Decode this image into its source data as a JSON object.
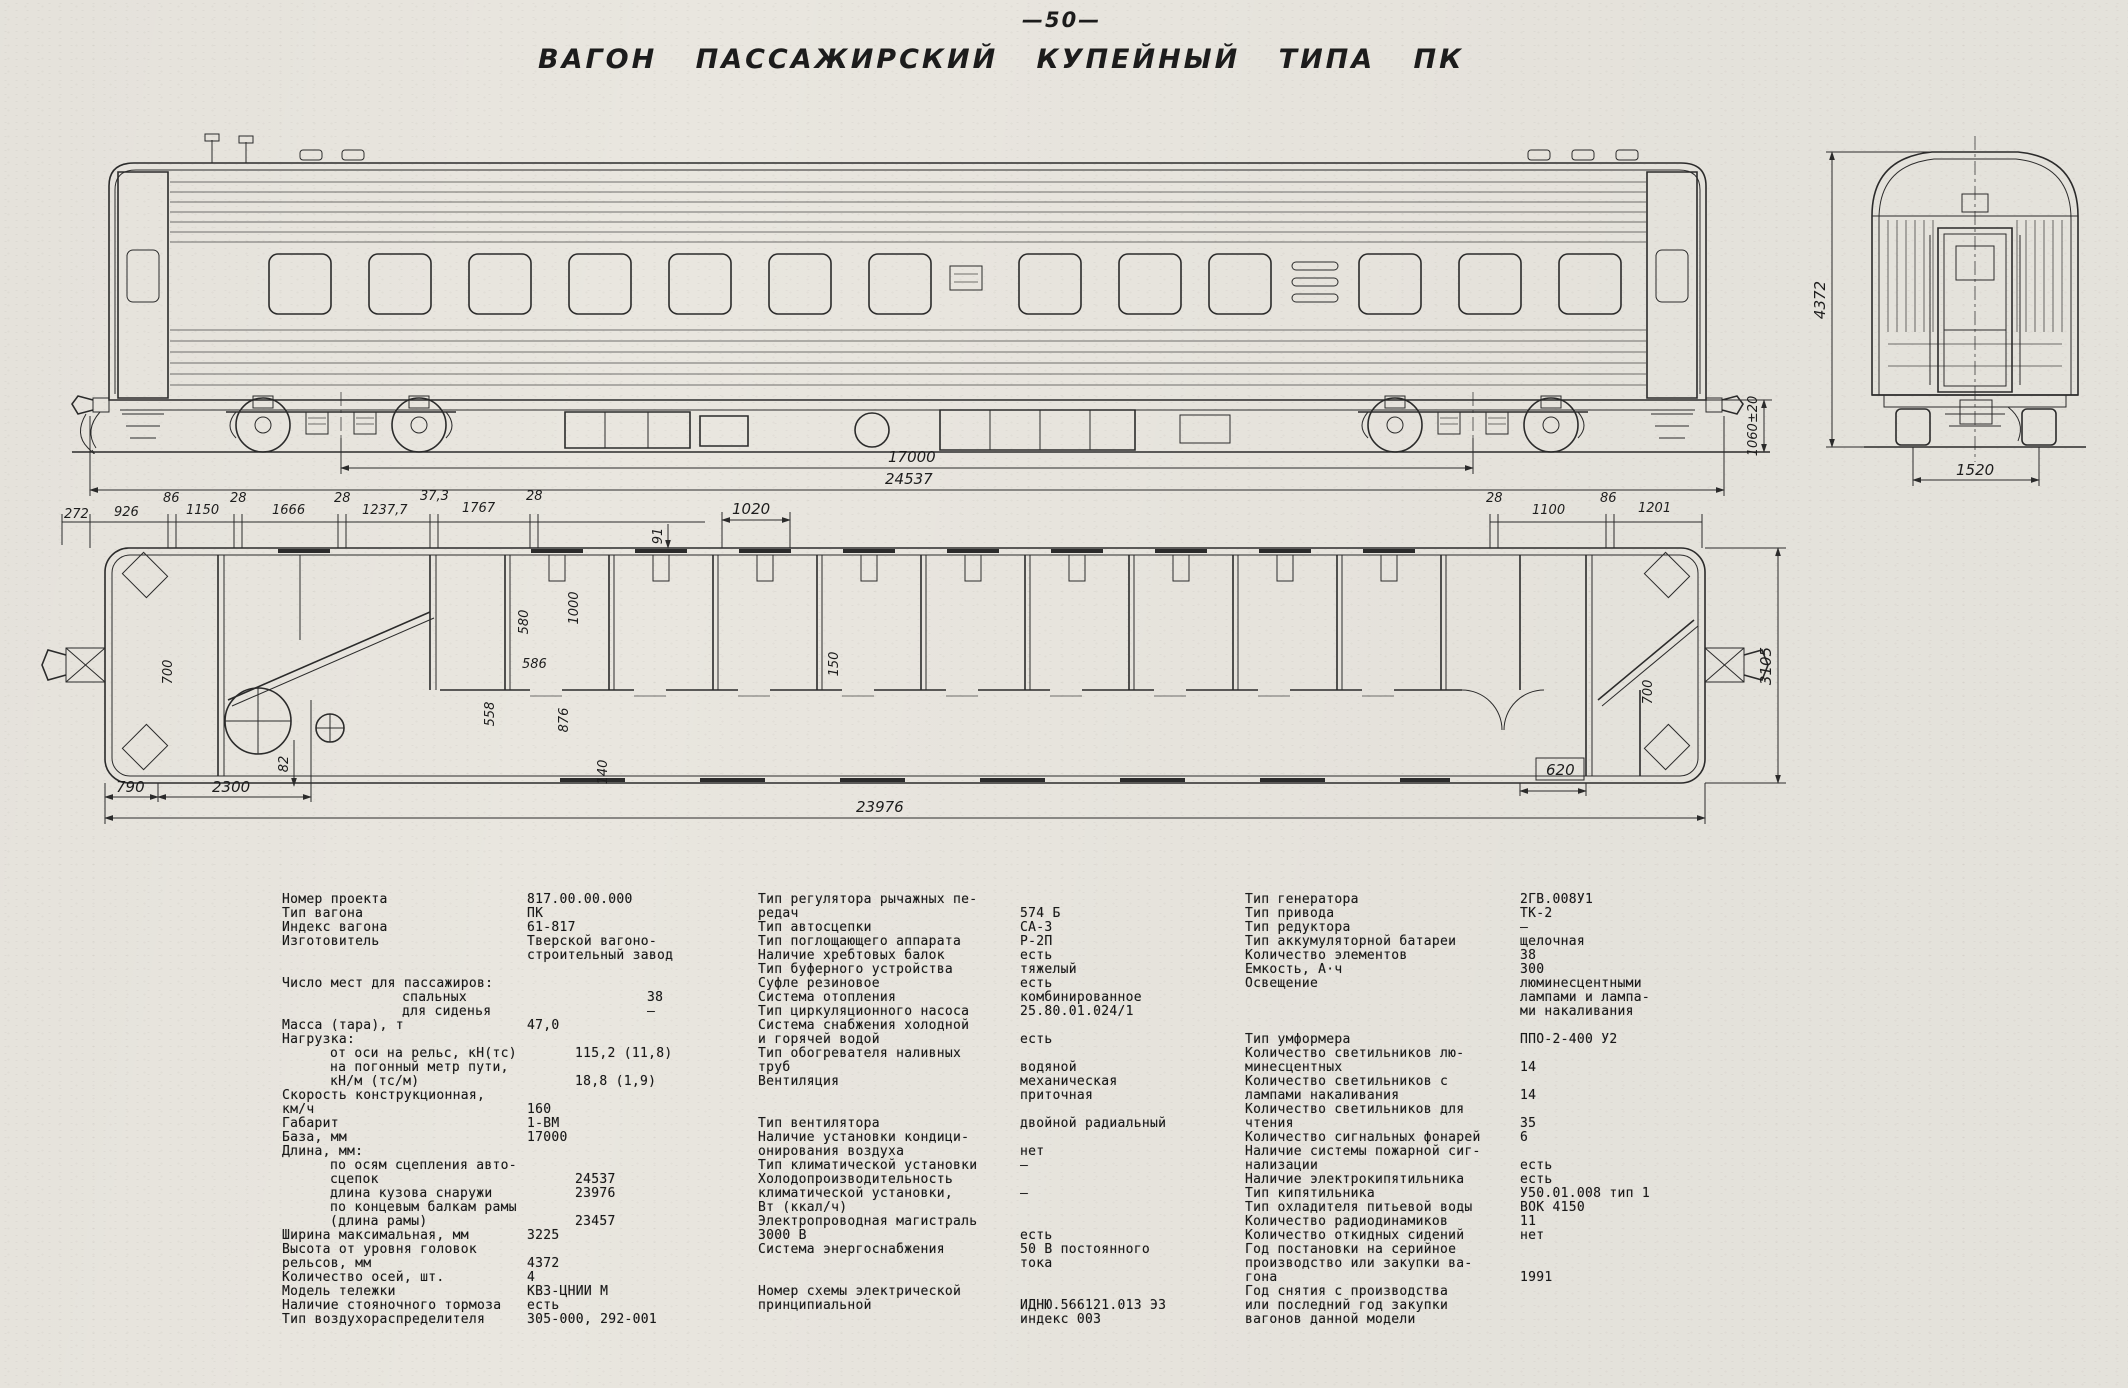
{
  "header": {
    "page_number": "—50—",
    "title": "ВАГОН ПАССАЖИРСКИЙ КУПЕЙНЫЙ ТИПА ПК"
  },
  "dims": {
    "side": {
      "wheelbase": "17000",
      "over_couplers": "24537",
      "coupler_height": "1060±20"
    },
    "end_view": {
      "height": "4372",
      "base_width": "1520"
    },
    "plan_top": [
      "272",
      "926",
      "86",
      "1150",
      "28",
      "1666",
      "28",
      "1237,7",
      "37,3",
      "1767",
      "28",
      "1020",
      "91",
      "28",
      "1100",
      "86",
      "1201"
    ],
    "plan_right": "3105",
    "plan_bottom": {
      "left_a": "790",
      "left_b": "2300",
      "left_c": "82",
      "right_box": "620",
      "overall": "23976"
    },
    "plan_interior": [
      "580",
      "1000",
      "586",
      "558",
      "876",
      "140",
      "700",
      "150",
      "700"
    ]
  },
  "specs": {
    "columns": [
      {
        "rows": [
          {
            "l": "Номер проекта",
            "v": "817.00.00.000"
          },
          {
            "l": "Тип вагона",
            "v": "ПК"
          },
          {
            "l": "Индекс вагона",
            "v": "61-817"
          },
          {
            "l": "Изготовитель",
            "v": "Тверской вагоно-"
          },
          {
            "l": "",
            "v": "строительный завод"
          },
          {
            "l": "Число мест для пассажиров:",
            "v": "",
            "gap": 1
          },
          {
            "l": "спальных",
            "v": "38",
            "i": 2
          },
          {
            "l": "для сиденья",
            "v": "—",
            "i": 2
          },
          {
            "l": "Масса (тара), т",
            "v": "47,0"
          },
          {
            "l": "Нагрузка:",
            "v": ""
          },
          {
            "l": "от оси на рельс, кН(тс)",
            "v": "115,2 (11,8)",
            "i": 1
          },
          {
            "l": "на погонный метр пути,",
            "v": "",
            "i": 1
          },
          {
            "l": "кН/м (тс/м)",
            "v": "18,8 (1,9)",
            "i": 1
          },
          {
            "l": "Скорость конструкционная,",
            "v": ""
          },
          {
            "l": "км/ч",
            "v": "160"
          },
          {
            "l": "Габарит",
            "v": "1-ВМ"
          },
          {
            "l": "База, мм",
            "v": "17000"
          },
          {
            "l": "Длина, мм:",
            "v": ""
          },
          {
            "l": "по осям сцепления авто-",
            "v": "",
            "i": 1
          },
          {
            "l": "сцепок",
            "v": "24537",
            "i": 1
          },
          {
            "l": "длина кузова снаружи",
            "v": "23976",
            "i": 1
          },
          {
            "l": "по концевым балкам рамы",
            "v": "",
            "i": 1
          },
          {
            "l": "(длина рамы)",
            "v": "23457",
            "i": 1
          },
          {
            "l": "Ширина максимальная, мм",
            "v": "3225"
          },
          {
            "l": "Высота от уровня головок",
            "v": ""
          },
          {
            "l": "рельсов, мм",
            "v": "4372"
          },
          {
            "l": "Количество осей, шт.",
            "v": "4"
          },
          {
            "l": "Модель тележки",
            "v": "КВЗ-ЦНИИ М"
          },
          {
            "l": "Наличие стояночного тормоза",
            "v": "есть"
          },
          {
            "l": "Тип воздухораспределителя",
            "v": "305-000, 292-001"
          }
        ]
      },
      {
        "rows": [
          {
            "l": "Тип регулятора рычажных пе-",
            "v": ""
          },
          {
            "l": "редач",
            "v": "574 Б"
          },
          {
            "l": "Тип автосцепки",
            "v": "СА-3"
          },
          {
            "l": "Тип поглощающего аппарата",
            "v": "Р-2П"
          },
          {
            "l": "Наличие хребтовых балок",
            "v": "есть"
          },
          {
            "l": "Тип буферного устройства",
            "v": "тяжелый"
          },
          {
            "l": "Суфле резиновое",
            "v": "есть"
          },
          {
            "l": "Система отопления",
            "v": "комбинированное"
          },
          {
            "l": "Тип циркуляционного насоса",
            "v": "25.80.01.024/1"
          },
          {
            "l": "Система снабжения холодной",
            "v": ""
          },
          {
            "l": "и горячей водой",
            "v": "есть"
          },
          {
            "l": "Тип обогревателя наливных",
            "v": ""
          },
          {
            "l": "труб",
            "v": "водяной"
          },
          {
            "l": "Вентиляция",
            "v": "механическая"
          },
          {
            "l": "",
            "v": "приточная"
          },
          {
            "l": "Тип вентилятора",
            "v": "двойной радиальный",
            "gap": 1
          },
          {
            "l": "Наличие установки кондици-",
            "v": ""
          },
          {
            "l": "онирования воздуха",
            "v": "нет"
          },
          {
            "l": "Тип климатической установки",
            "v": "—"
          },
          {
            "l": "Холодопроизводительность",
            "v": ""
          },
          {
            "l": "климатической установки,",
            "v": "—"
          },
          {
            "l": "Вт (ккал/ч)",
            "v": ""
          },
          {
            "l": "Электропроводная магистраль",
            "v": ""
          },
          {
            "l": "3000 В",
            "v": "есть"
          },
          {
            "l": "Система энергоснабжения",
            "v": "50 В постоянного"
          },
          {
            "l": "",
            "v": "тока"
          },
          {
            "l": "Номер схемы электрической",
            "v": "",
            "gap": 1
          },
          {
            "l": "принципиальной",
            "v": "ИДНЮ.566121.013 Э3"
          },
          {
            "l": "",
            "v": "индекс 003"
          }
        ]
      },
      {
        "rows": [
          {
            "l": "Тип генератора",
            "v": "2ГВ.008У1"
          },
          {
            "l": "Тип привода",
            "v": "ТК-2"
          },
          {
            "l": "Тип редуктора",
            "v": "—"
          },
          {
            "l": "Тип аккумуляторной батареи",
            "v": "щелочная"
          },
          {
            "l": "Количество элементов",
            "v": "38"
          },
          {
            "l": "Емкость, А·ч",
            "v": "300"
          },
          {
            "l": "Освещение",
            "v": "люминесцентными"
          },
          {
            "l": "",
            "v": "лампами и лампа-"
          },
          {
            "l": "",
            "v": "ми накаливания"
          },
          {
            "l": "Тип умформера",
            "v": "ППО-2-400 У2",
            "gap": 1
          },
          {
            "l": "Количество светильников лю-",
            "v": ""
          },
          {
            "l": "минесцентных",
            "v": "14"
          },
          {
            "l": "Количество светильников с",
            "v": ""
          },
          {
            "l": "лампами накаливания",
            "v": "14"
          },
          {
            "l": "Количество светильников для",
            "v": ""
          },
          {
            "l": "чтения",
            "v": "35"
          },
          {
            "l": "Количество сигнальных фонарей",
            "v": "6"
          },
          {
            "l": "Наличие системы пожарной сиг-",
            "v": ""
          },
          {
            "l": "нализации",
            "v": "есть"
          },
          {
            "l": "Наличие электрокипятильника",
            "v": "есть"
          },
          {
            "l": "Тип кипятильника",
            "v": "У50.01.008 тип 1"
          },
          {
            "l": "Тип охладителя питьевой воды",
            "v": "ВОК 4150"
          },
          {
            "l": "Количество радиодинамиков",
            "v": "11"
          },
          {
            "l": "Количество откидных сидений",
            "v": "нет"
          },
          {
            "l": "Год постановки на серийное",
            "v": ""
          },
          {
            "l": "производство или закупки ва-",
            "v": ""
          },
          {
            "l": "гона",
            "v": "1991"
          },
          {
            "l": "Год снятия с производства",
            "v": ""
          },
          {
            "l": "или последний год закупки",
            "v": ""
          },
          {
            "l": "вагонов данной модели",
            "v": ""
          }
        ]
      }
    ]
  }
}
